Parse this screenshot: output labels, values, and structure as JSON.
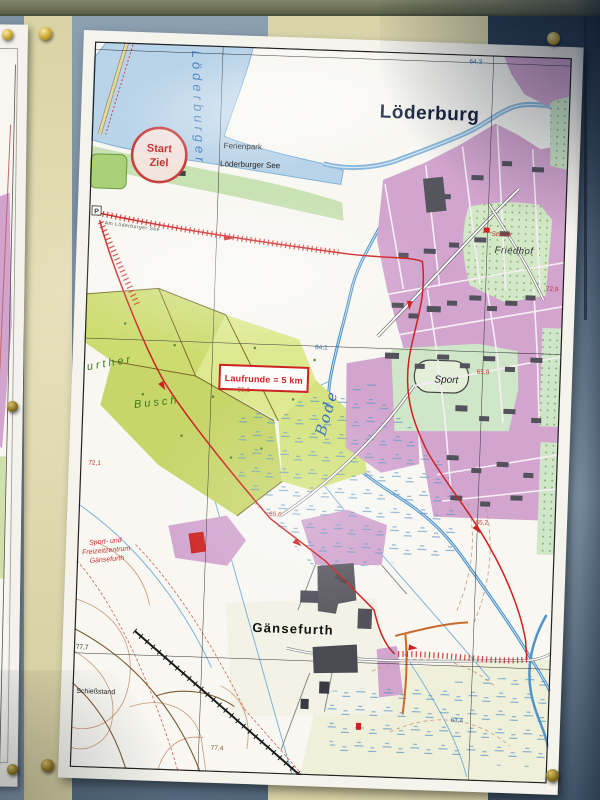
{
  "map": {
    "town_title": "Löderburg",
    "start_marker": {
      "line1": "Start",
      "line2": "Ziel"
    },
    "resort": {
      "line1": "Ferienpark",
      "line2": "Löderburger See"
    },
    "route_badge": "Laufrunde = 5 km",
    "river_label": "Bode",
    "lake_label": "Löderburger",
    "street_label": "Am Löderburger See",
    "sport_label": "Sport",
    "cemetery_label": "Friedhof",
    "school_label": "Schule",
    "village_label": "Gänsefurth",
    "leisure_center": {
      "line1": "Sport- und",
      "line2": "Freizeitzentrum",
      "line3": "Gänsefurth"
    },
    "stable_label": "Stall",
    "shooting_range_label": "Schießstand",
    "forest_label": {
      "line1": "urther",
      "line2": "Busch"
    },
    "parking_label": "P",
    "elevations": [
      {
        "value": "64,3",
        "color": "#3a6ea8",
        "x": 374,
        "y": 9
      },
      {
        "value": "72,9",
        "color": "#c0392b",
        "x": 458,
        "y": 233
      },
      {
        "value": "64,1",
        "color": "#3a6ea8",
        "x": 230,
        "y": 299
      },
      {
        "value": "66,1",
        "color": "#c0392b",
        "x": 154,
        "y": 344
      },
      {
        "value": "65,8",
        "color": "#c0392b",
        "x": 392,
        "y": 318
      },
      {
        "value": "72,1",
        "color": "#c0392b",
        "x": 8,
        "y": 422
      },
      {
        "value": "65,6",
        "color": "#c0392b",
        "x": 190,
        "y": 467
      },
      {
        "value": "65,2",
        "color": "#c0392b",
        "x": 396,
        "y": 468
      },
      {
        "value": "63,4",
        "color": "#3a6ea8",
        "x": 378,
        "y": 666
      },
      {
        "value": "77,4",
        "color": "#8a5a30",
        "x": 140,
        "y": 702
      },
      {
        "value": "77,7",
        "color": "#333333",
        "x": 2,
        "y": 606
      }
    ],
    "colors": {
      "route_red": "#cc2222",
      "water_blue": "#8ab8dc",
      "town_pink": "#d2a5cf",
      "forest_green": "#ccdc6e",
      "board_navy": "#3c5068",
      "board_cream": "#e2dcb4",
      "pin_brass": "#c9a832"
    }
  }
}
